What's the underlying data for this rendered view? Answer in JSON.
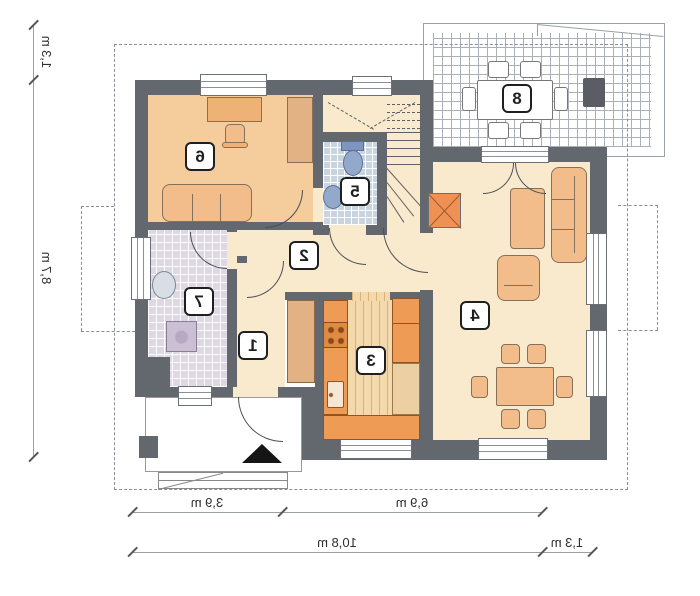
{
  "room_labels": [
    "1",
    "2",
    "3",
    "4",
    "5",
    "6",
    "7",
    "8"
  ],
  "dimensions": {
    "left_upper": "1,3 m",
    "left_main": "8,7 m",
    "bottom_seg_left": "3,9 m",
    "bottom_seg_right": "6,9 m",
    "bottom_total": "10,8 m",
    "bottom_right": "1,3 m"
  },
  "colors": {
    "wall": "#63676e",
    "floor_hall": "#faeacd",
    "floor_bedroom": "#f5cc9c",
    "furniture": "#f2bd8a",
    "kitchen_counter": "#ee9c55",
    "fireplace": "#ef9054",
    "bathroom_tile": "#ded7e5",
    "wc_tile": "#c9d4e1",
    "fixture_blue": "#93a9cc",
    "roof_dash": "#8a8f96"
  }
}
